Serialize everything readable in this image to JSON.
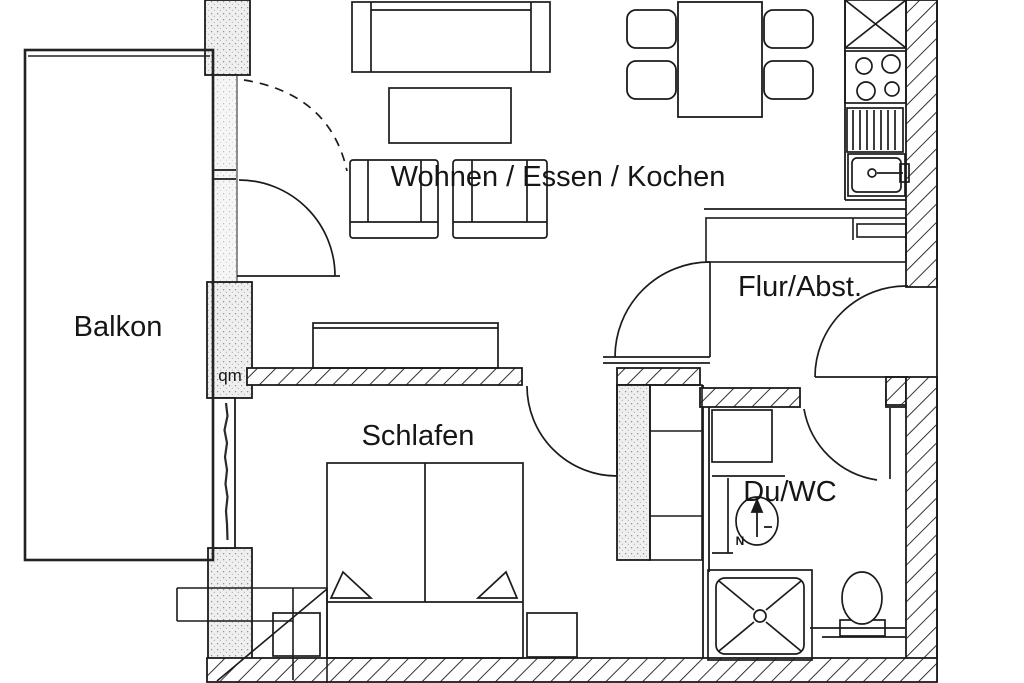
{
  "document": {
    "type": "apartment-floor-plan"
  },
  "labels": {
    "living": "Wohnen / Essen / Kochen",
    "balcony": "Balkon",
    "bedroom": "Schlafen",
    "hall": "Flur/Abst.",
    "bath": "Du/WC",
    "area_unit": "qm",
    "north": "N"
  },
  "colors": {
    "line": "#1b1b1b",
    "background": "#ffffff",
    "wall_stipple": "#efefef"
  },
  "fixtures": [
    "sofa",
    "coffee-table",
    "armchair",
    "armchair",
    "sideboard",
    "dining-table",
    "dining-chair",
    "dining-chair",
    "dining-chair",
    "dining-chair",
    "kitchen-tall-cabinet",
    "stove",
    "oven",
    "kitchen-sink",
    "hall-cabinet",
    "wardrobe",
    "double-bed",
    "pillow",
    "pillow",
    "nightstand",
    "nightstand",
    "shower",
    "toilet",
    "washbasin",
    "north-arrow",
    "balcony-door",
    "room-door",
    "bedroom-door",
    "bath-door",
    "entrance-door"
  ]
}
